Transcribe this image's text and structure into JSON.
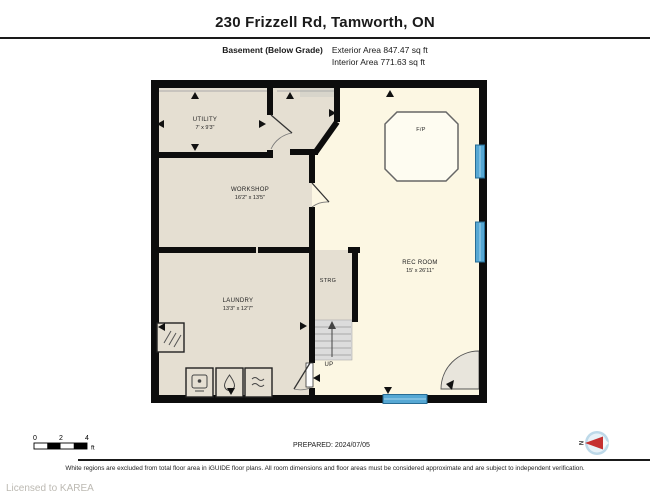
{
  "header": {
    "title": "230 Frizzell Rd, Tamworth, ON",
    "floor_label": "Basement (Below Grade)",
    "exterior_area": "Exterior Area 847.47 sq ft",
    "interior_area": "Interior Area 771.63 sq ft"
  },
  "rooms": [
    {
      "name": "UTILITY",
      "dims": "7' x 9'3\""
    },
    {
      "name": "WORKSHOP",
      "dims": "16'2\" x 13'5\""
    },
    {
      "name": "LAUNDRY",
      "dims": "13'3\" x 12'7\""
    },
    {
      "name": "STRG",
      "dims": ""
    },
    {
      "name": "REC ROOM",
      "dims": "15' x 26'11\""
    }
  ],
  "plan_labels": {
    "fireplace": "F/P",
    "stairs_up": "UP"
  },
  "scale_bar": {
    "ticks": [
      "0",
      "2",
      "4"
    ],
    "unit": "ft"
  },
  "footer": {
    "prepared": "PREPARED: 2024/07/05",
    "disclaimer": "White regions are excluded from total floor area in iGUIDE floor plans. All room dimensions and floor areas must be considered approximate and are subject to independent verification.",
    "license": "Licensed to KAREA",
    "compass_label": "N"
  },
  "colors": {
    "wall": "#0d0d0d",
    "room_beige": "#e5dfd2",
    "room_cream": "#fcf7e3",
    "window_blue": "#56a8d4",
    "stairs_gray": "#dcdcdc",
    "compass_red": "#c53030"
  }
}
